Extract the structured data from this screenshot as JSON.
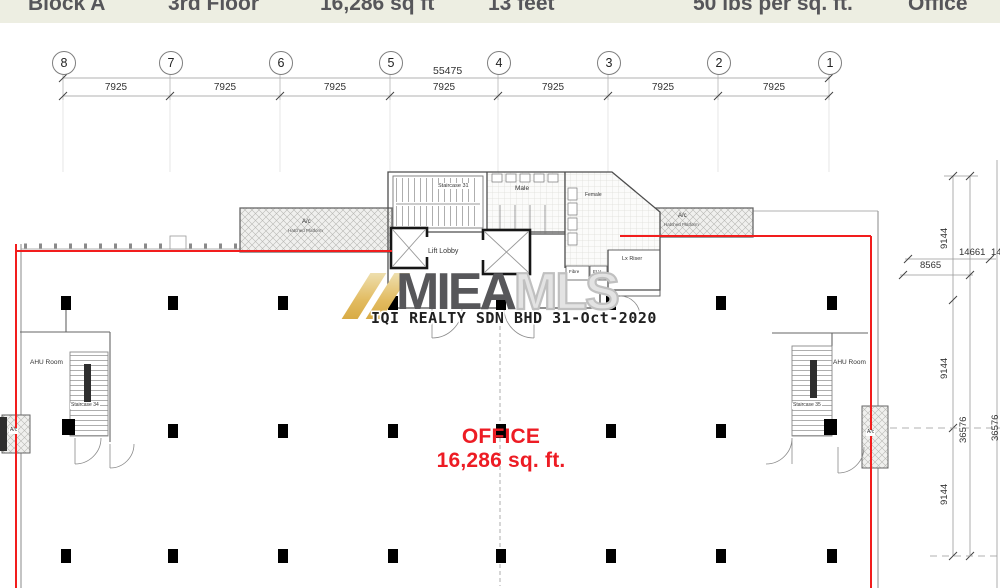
{
  "header": {
    "cells": [
      "Block A",
      "3rd Floor",
      "16,286 sq ft",
      "13 feet",
      "50 lbs per sq. ft.",
      "Office"
    ]
  },
  "grid": {
    "bubbles": [
      "8",
      "7",
      "6",
      "5",
      "4",
      "3",
      "2",
      "1"
    ],
    "overall_dim": "55475",
    "bay_dim": "7925"
  },
  "dims_right": {
    "bay_v": "9144",
    "total_v": "36576",
    "offset_a": "14661",
    "offset_b": "8565"
  },
  "watermark": {
    "brand_dark": "MIEA",
    "brand_light": "MLS",
    "caption": "IQI REALTY SDN BHD 31-Oct-2020",
    "gold": "#e2bb60"
  },
  "office_label": {
    "line1": "OFFICE",
    "line2": "16,286 sq. ft."
  },
  "rooms": {
    "staircase_top": "Staircase 31",
    "male": "Male",
    "female": "Female",
    "lift_lobby": "Lift Lobby",
    "lx_riser": "Lx Riser",
    "fibre": "Fibre",
    "elv": "ELV",
    "ahu": "AHU Room",
    "staircase_left": "Staircase 34",
    "staircase_right": "Staircase 35",
    "ac": "A/c",
    "ac_sub": "Hatched Platform"
  },
  "colors": {
    "accent_red": "#ed1c24",
    "boundary_red": "#f21d1d",
    "header_bg": "#edeee2"
  }
}
